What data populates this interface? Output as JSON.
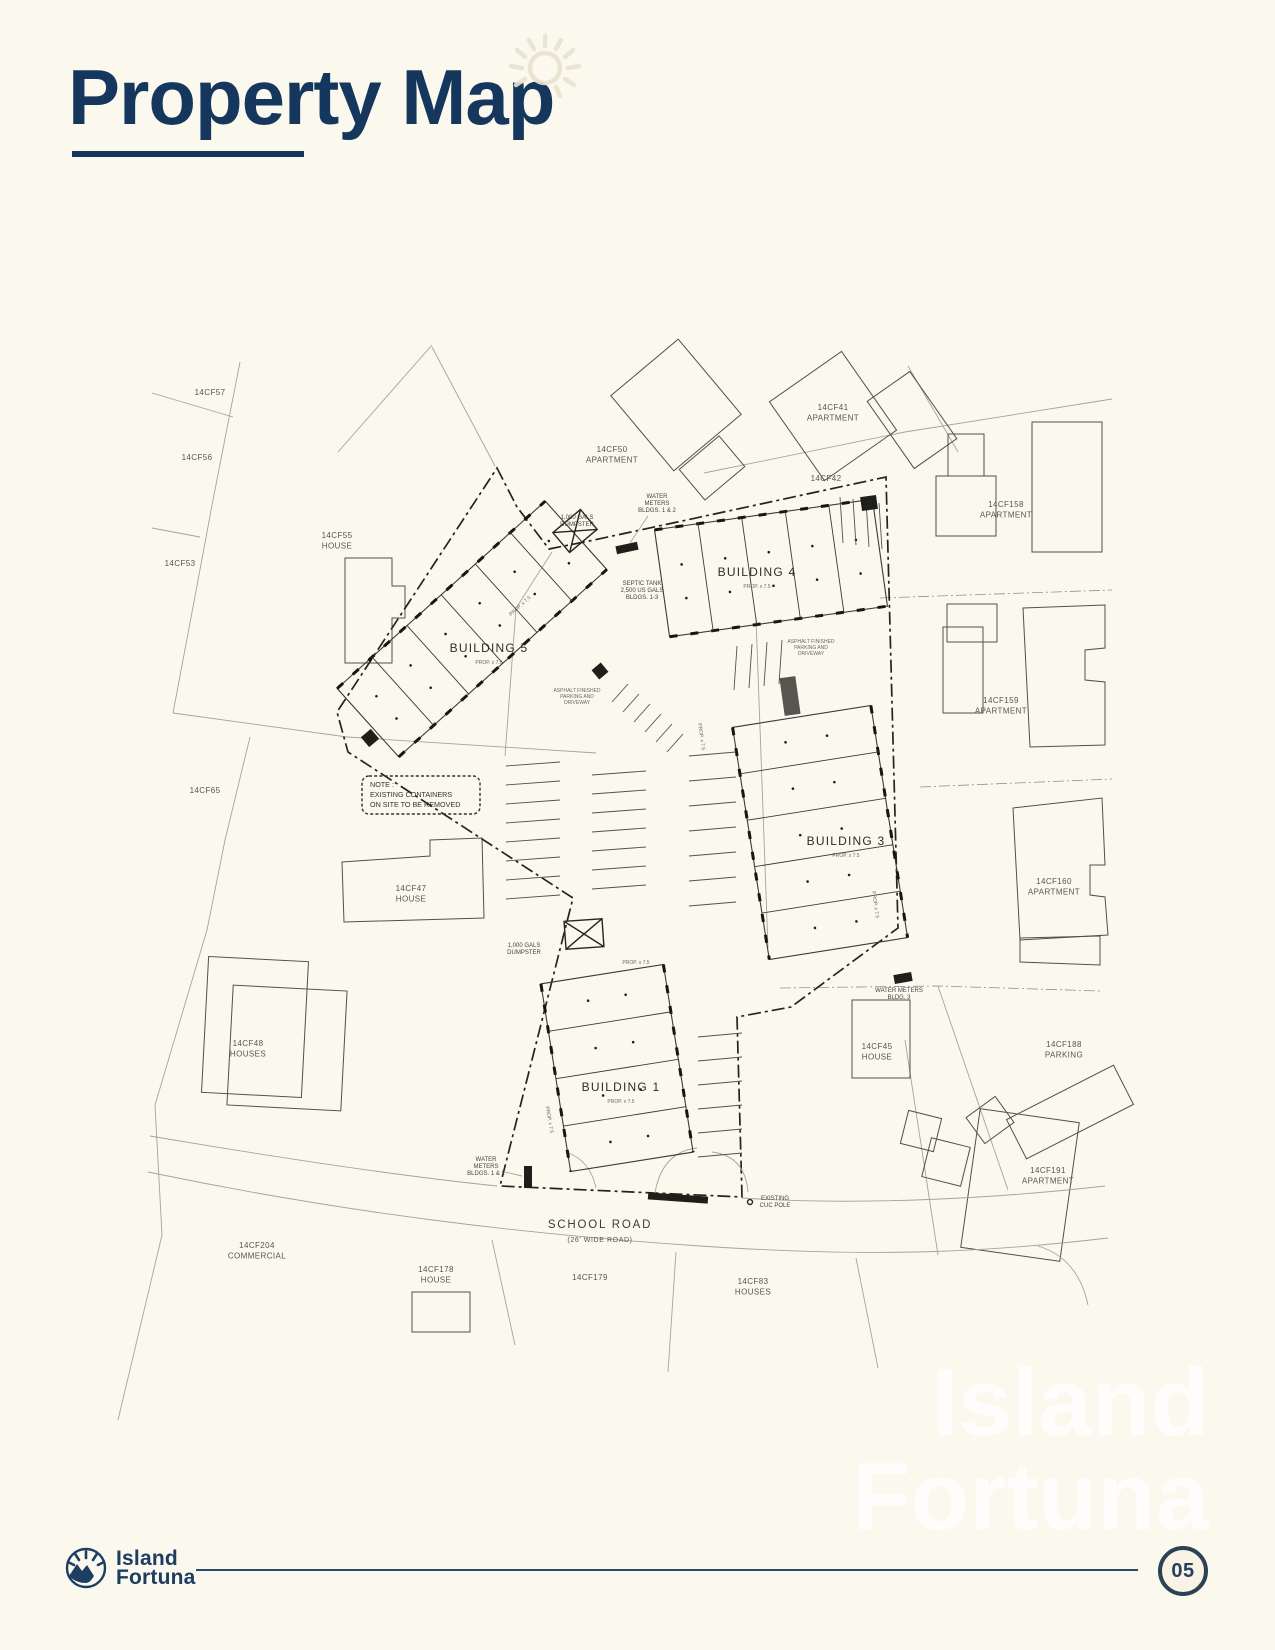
{
  "page": {
    "title": "Property Map",
    "page_number": "05"
  },
  "brand": {
    "line1": "Island",
    "line2": "Fortuna"
  },
  "watermark": {
    "line1": "Island",
    "line2": "Fortuna"
  },
  "map": {
    "tiny": "PROP. x 7.5",
    "parcels": [
      {
        "l1": "14CF57",
        "l2": ""
      },
      {
        "l1": "14CF56",
        "l2": ""
      },
      {
        "l1": "14CF55",
        "l2": "HOUSE"
      },
      {
        "l1": "14CF53",
        "l2": ""
      },
      {
        "l1": "14CF50",
        "l2": "APARTMENT"
      },
      {
        "l1": "14CF41",
        "l2": "APARTMENT"
      },
      {
        "l1": "14CF42",
        "l2": ""
      },
      {
        "l1": "14CF158",
        "l2": "APARTMENT"
      },
      {
        "l1": "14CF159",
        "l2": "APARTMENT"
      },
      {
        "l1": "14CF160",
        "l2": "APARTMENT"
      },
      {
        "l1": "14CF65",
        "l2": ""
      },
      {
        "l1": "14CF47",
        "l2": "HOUSE"
      },
      {
        "l1": "14CF48",
        "l2": "HOUSES"
      },
      {
        "l1": "14CF45",
        "l2": "HOUSE"
      },
      {
        "l1": "14CF188",
        "l2": "PARKING"
      },
      {
        "l1": "14CF191",
        "l2": "APARTMENT"
      },
      {
        "l1": "14CF204",
        "l2": "COMMERCIAL"
      },
      {
        "l1": "14CF178",
        "l2": "HOUSE"
      },
      {
        "l1": "14CF179",
        "l2": ""
      },
      {
        "l1": "14CF83",
        "l2": "HOUSES"
      }
    ],
    "buildings": [
      {
        "label": "BUILDING 5"
      },
      {
        "label": "BUILDING 4"
      },
      {
        "label": "BUILDING 3"
      },
      {
        "label": "BUILDING 1"
      }
    ],
    "ann": {
      "water_meters": {
        "l1": "WATER",
        "l2": "METERS",
        "l3": "BLDGS. 1 & 2"
      },
      "dumpster": {
        "l1": "1,000 GALS",
        "l2": "DUMPSTER"
      },
      "septic": {
        "l1": "SEPTIC TANK",
        "l2": "2,500 US GALS",
        "l3": "BLDGS. 1-3"
      },
      "asphalt": {
        "l1": "ASPHALT FINISHED",
        "l2": "PARKING AND",
        "l3": "DRIVEWAY"
      },
      "water_meter_b3": {
        "l1": "WATER METERS",
        "l2": "BLDG. 3"
      },
      "cuc_pole": {
        "l1": "EXISTING",
        "l2": "CUC POLE"
      }
    },
    "note": {
      "l1": "NOTE :",
      "l2": "EXISTING CONTAINERS",
      "l3": "ON SITE TO BE REMOVED"
    },
    "road": {
      "name": "SCHOOL ROAD",
      "sub": "(26' WIDE ROAD)"
    }
  }
}
